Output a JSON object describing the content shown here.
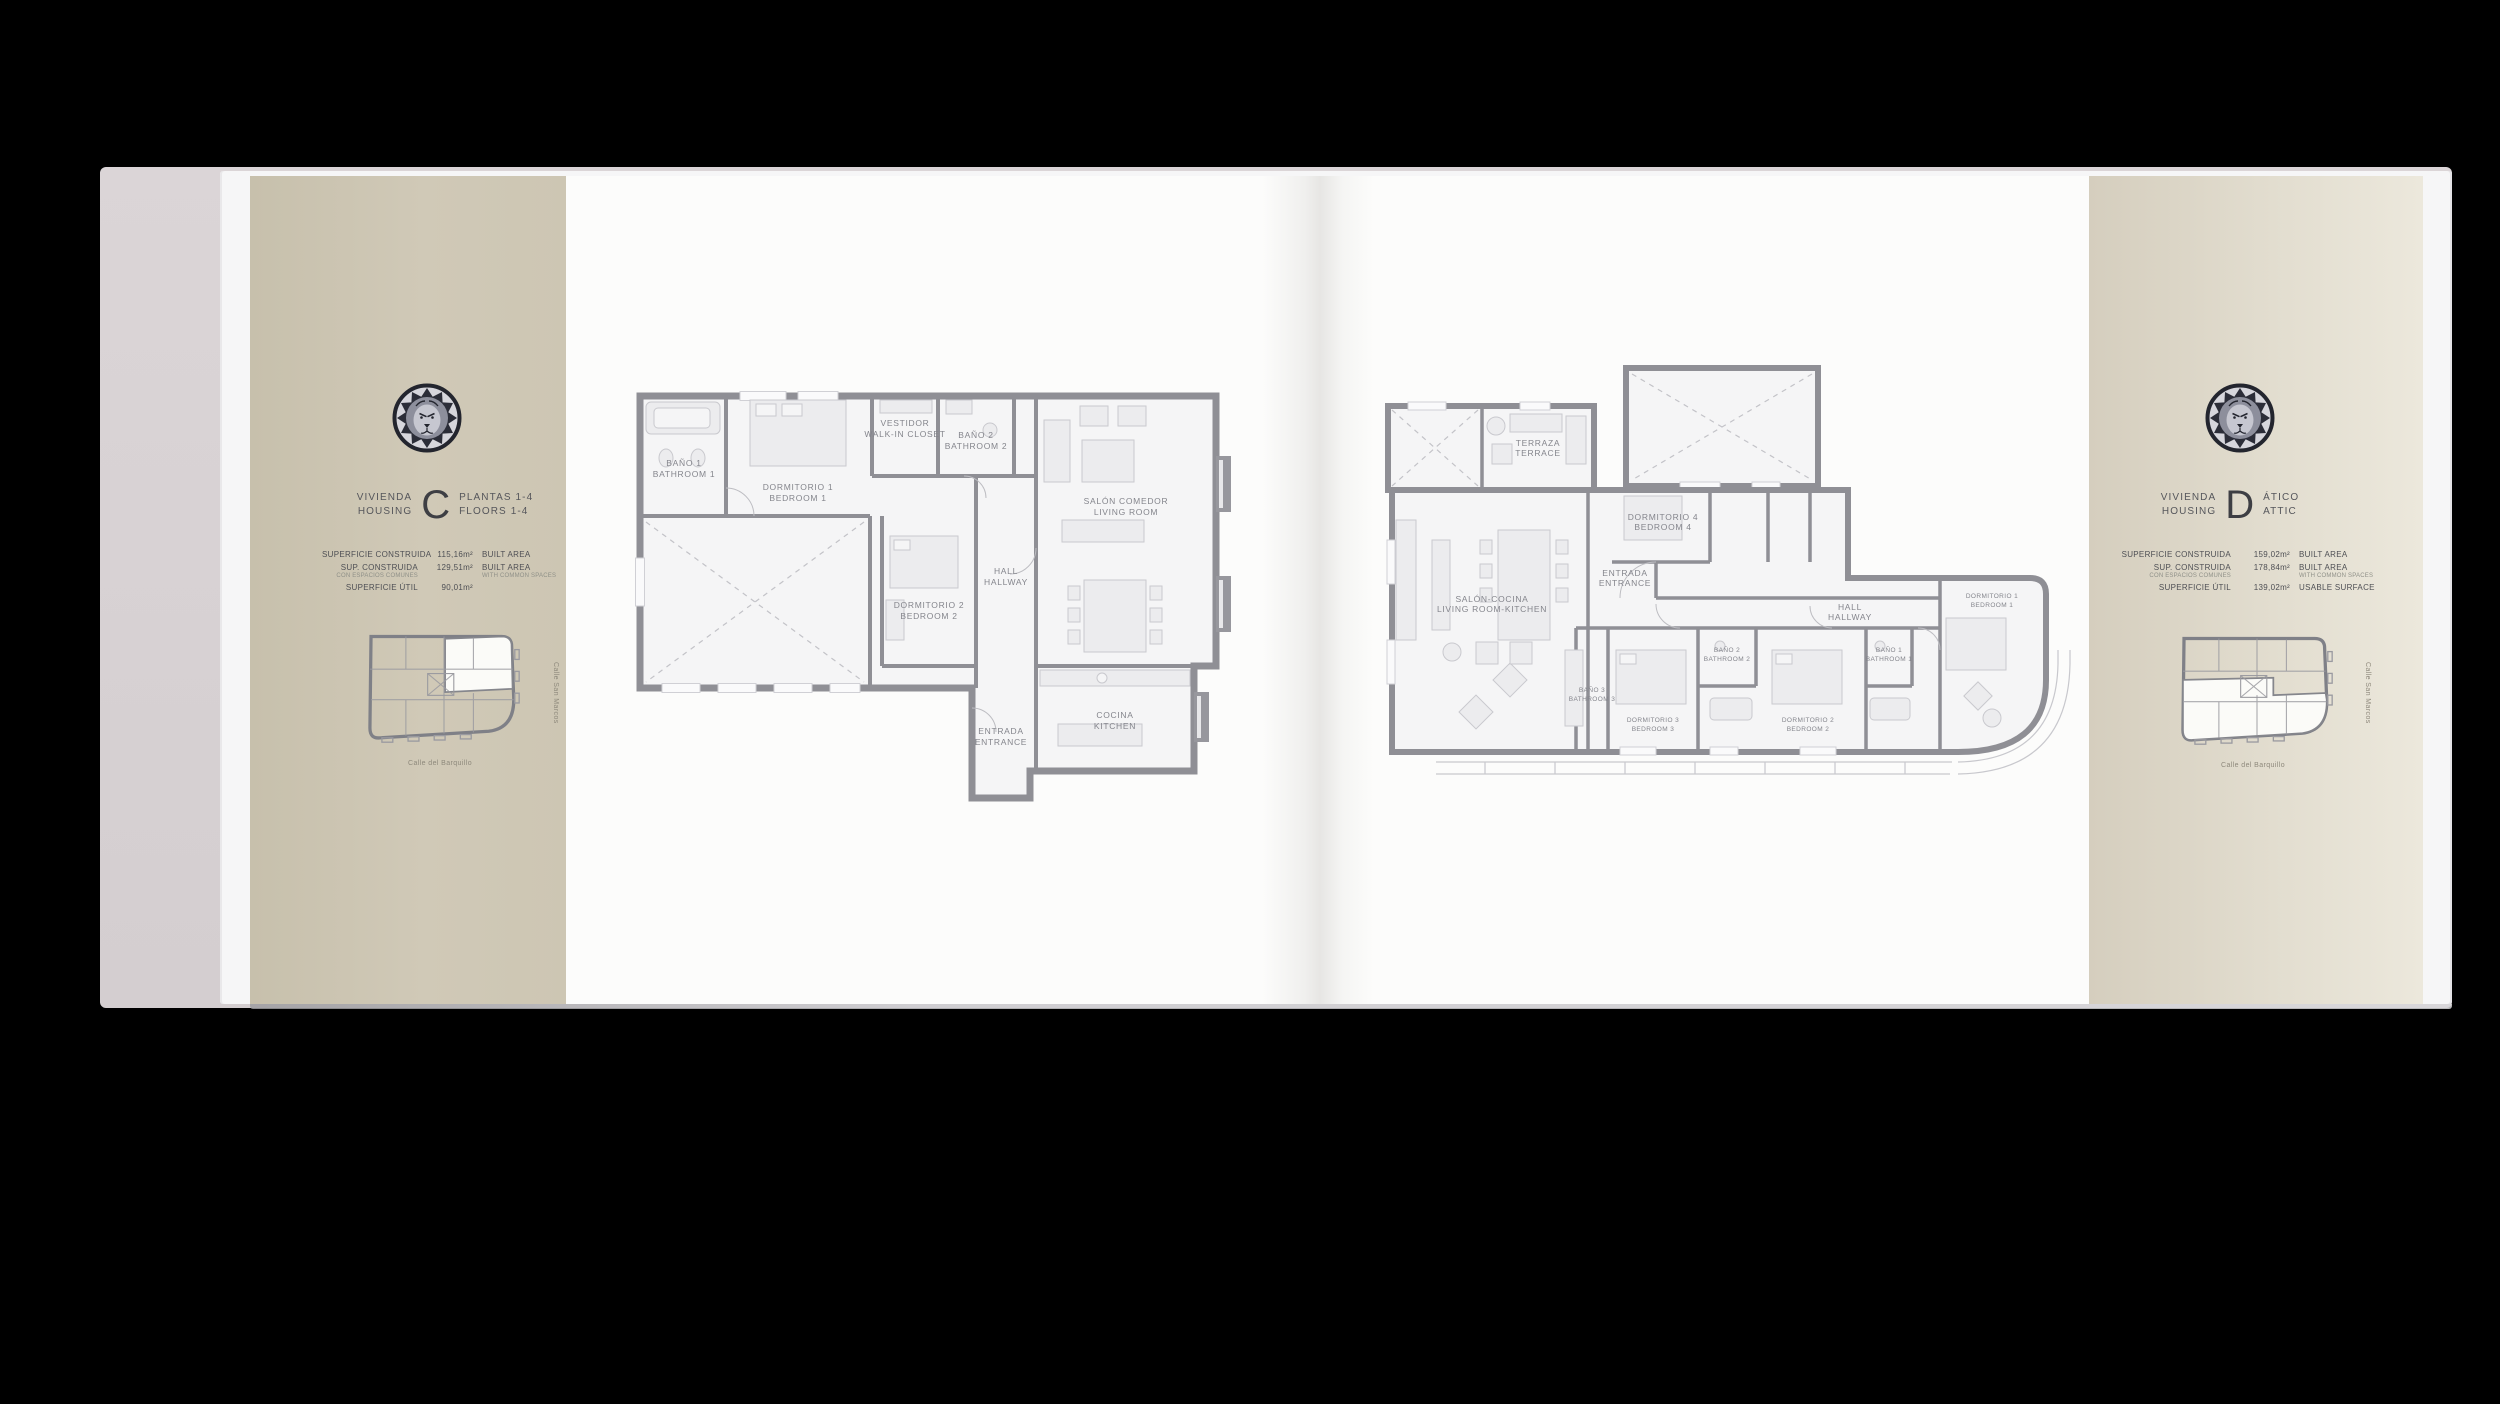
{
  "scene": {
    "background": "#000000",
    "description": "Open real-estate brochure spread showing floor plans for Housing C and Housing D"
  },
  "brand": {
    "logo": "lion-emblem"
  },
  "left": {
    "title": {
      "label_top": "VIVIENDA",
      "label_bottom": "HOUSING",
      "letter": "C",
      "sub_top": "PLANTAS 1-4",
      "sub_bottom": "FLOORS 1-4"
    },
    "areas": {
      "row1": {
        "es": "SUPERFICIE CONSTRUIDA",
        "value": "115,16m²",
        "en": "BUILT AREA"
      },
      "row2": {
        "es": "SUP. CONSTRUIDA",
        "es_sub": "CON ESPACIOS COMUNES",
        "value": "129,51m²",
        "en": "BUILT AREA",
        "en_sub": "WITH COMMON SPACES"
      },
      "row3": {
        "es": "SUPERFICIE ÚTIL",
        "value": "90,01m²",
        "en": ""
      }
    },
    "key_plan": {
      "street_side": "Calle San Marcos",
      "street_bottom": "Calle del Barquillo"
    },
    "rooms": {
      "bath1": {
        "es": "BAÑO 1",
        "en": "BATHROOM 1"
      },
      "bed1": {
        "es": "DORMITORIO 1",
        "en": "BEDROOM 1"
      },
      "closet": {
        "es": "VESTIDOR",
        "en": "WALK-IN CLOSET"
      },
      "bath2": {
        "es": "BAÑO 2",
        "en": "BATHROOM 2"
      },
      "living": {
        "es": "SALÓN COMEDOR",
        "en": "LIVING ROOM"
      },
      "bed2": {
        "es": "DORMITORIO 2",
        "en": "BEDROOM 2"
      },
      "hall": {
        "es": "HALL",
        "en": "HALLWAY"
      },
      "entry": {
        "es": "ENTRADA",
        "en": "ENTRANCE"
      },
      "kitchen": {
        "es": "COCINA",
        "en": "KITCHEN"
      }
    }
  },
  "right": {
    "title": {
      "label_top": "VIVIENDA",
      "label_bottom": "HOUSING",
      "letter": "D",
      "sub_top": "ÁTICO",
      "sub_bottom": "ATTIC"
    },
    "areas": {
      "row1": {
        "es": "SUPERFICIE CONSTRUIDA",
        "value": "159,02m²",
        "en": "BUILT AREA"
      },
      "row2": {
        "es": "SUP. CONSTRUIDA",
        "es_sub": "CON ESPACIOS COMUNES",
        "value": "178,84m²",
        "en": "BUILT AREA",
        "en_sub": "WITH COMMON SPACES"
      },
      "row3": {
        "es": "SUPERFICIE ÚTIL",
        "value": "139,02m²",
        "en": "USABLE SURFACE"
      }
    },
    "key_plan": {
      "street_side": "Calle San Marcos",
      "street_bottom": "Calle del Barquillo"
    },
    "rooms": {
      "terrace": {
        "es": "TERRAZA",
        "en": "TERRACE"
      },
      "bed4": {
        "es": "DORMITORIO 4",
        "en": "BEDROOM 4"
      },
      "living": {
        "es": "SALÓN-COCINA",
        "en": "LIVING ROOM-KITCHEN"
      },
      "entry": {
        "es": "ENTRADA",
        "en": "ENTRANCE"
      },
      "hall": {
        "es": "HALL",
        "en": "HALLWAY"
      },
      "bath3": {
        "es": "BAÑO 3",
        "en": "BATHROOM 3"
      },
      "bed3": {
        "es": "DORMITORIO 3",
        "en": "BEDROOM 3"
      },
      "bath2": {
        "es": "BAÑO 2",
        "en": "BATHROOM 2"
      },
      "bed2": {
        "es": "DORMITORIO 2",
        "en": "BEDROOM 2"
      },
      "bath1": {
        "es": "BAÑO 1",
        "en": "BATHROOM 1"
      },
      "bed1": {
        "es": "DORMITORIO 1",
        "en": "BEDROOM 1"
      }
    }
  },
  "colors": {
    "band_left": "#cdc6b3",
    "band_right": "#e0dbcc",
    "wall": "#8f8f95",
    "page": "#fcfcfb",
    "cover": "#d8d2d4",
    "text": "#4e4f54",
    "plan_label": "#84858c",
    "emblem_dark": "#23252e"
  }
}
